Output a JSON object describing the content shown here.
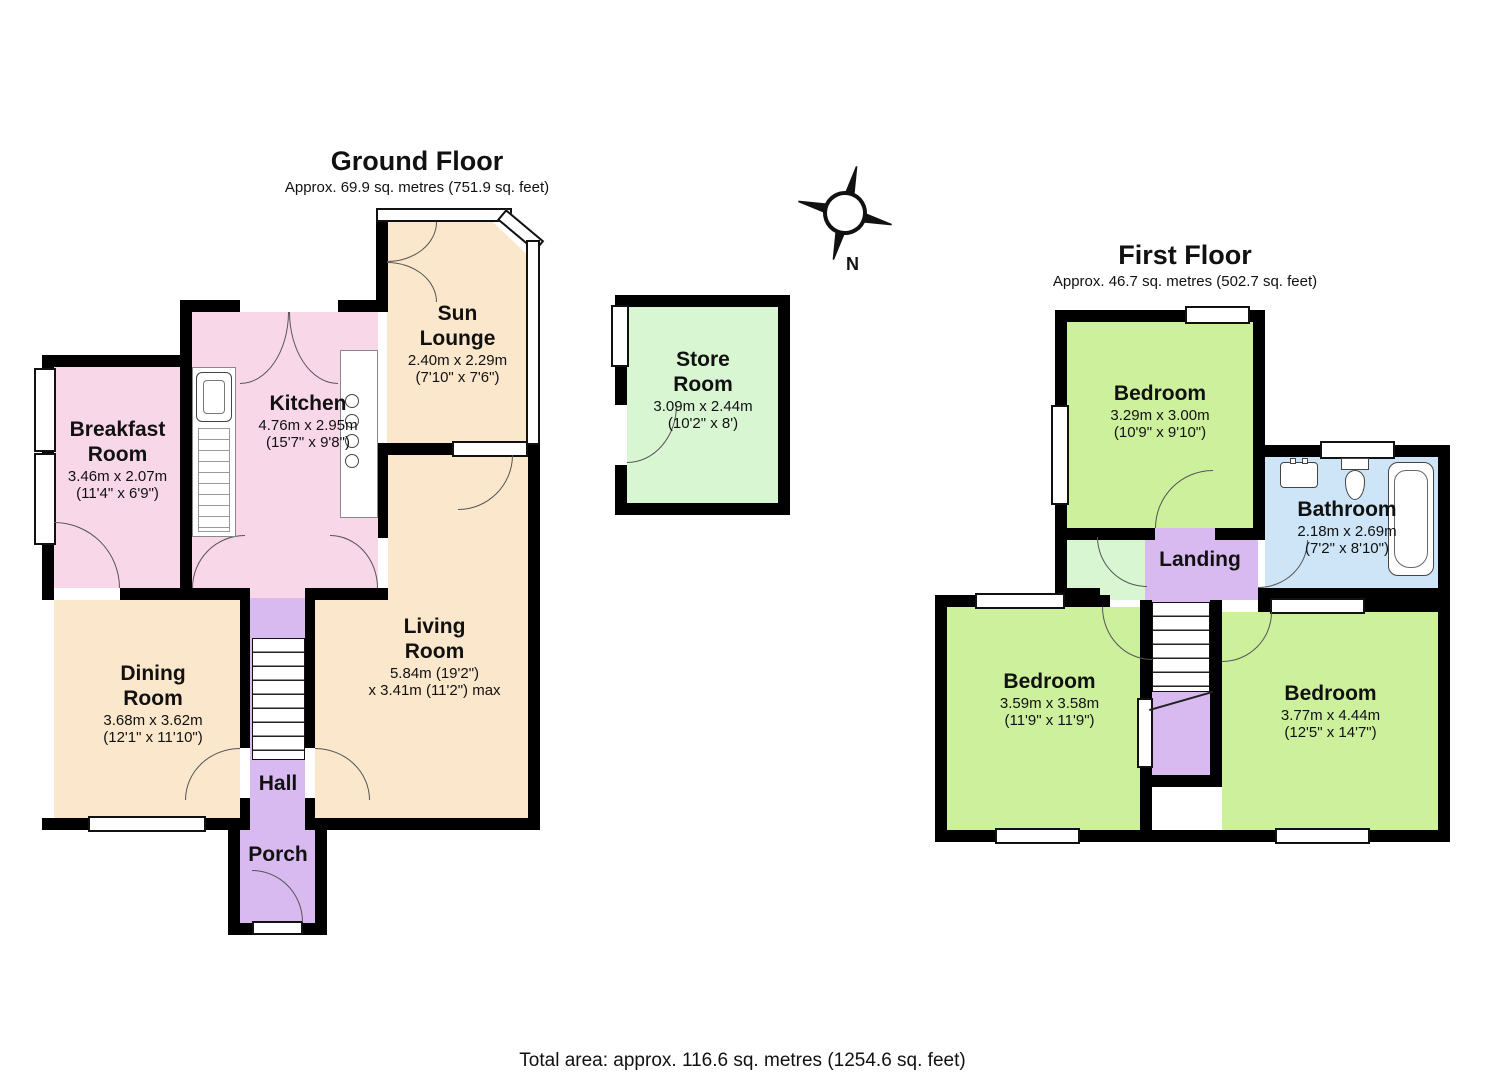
{
  "ground_floor": {
    "title": "Ground Floor",
    "subtitle": "Approx. 69.9 sq. metres (751.9 sq. feet)",
    "rooms": {
      "breakfast": {
        "name": "Breakfast Room",
        "dims1": "3.46m x 2.07m",
        "dims2": "(11'4\" x 6'9\")"
      },
      "kitchen": {
        "name": "Kitchen",
        "dims1": "4.76m x 2.95m",
        "dims2": "(15'7\" x 9'8\")"
      },
      "sun_lounge": {
        "name": "Sun Lounge",
        "dims1": "2.40m x 2.29m",
        "dims2": "(7'10\" x 7'6\")"
      },
      "dining": {
        "name": "Dining Room",
        "dims1": "3.68m x 3.62m",
        "dims2": "(12'1\" x 11'10\")"
      },
      "living": {
        "name": "Living Room",
        "dims1": "5.84m (19'2\")",
        "dims2": "x 3.41m (11'2\") max"
      },
      "hall": {
        "name": "Hall"
      },
      "porch": {
        "name": "Porch"
      }
    }
  },
  "store_room": {
    "name": "Store Room",
    "dims1": "3.09m x 2.44m",
    "dims2": "(10'2\" x 8')"
  },
  "first_floor": {
    "title": "First Floor",
    "subtitle": "Approx. 46.7 sq. metres (502.7 sq. feet)",
    "rooms": {
      "bedroom_top": {
        "name": "Bedroom",
        "dims1": "3.29m x 3.00m",
        "dims2": "(10'9\" x 9'10\")"
      },
      "bathroom": {
        "name": "Bathroom",
        "dims1": "2.18m x 2.69m",
        "dims2": "(7'2\" x 8'10\")"
      },
      "landing": {
        "name": "Landing"
      },
      "bedroom_left": {
        "name": "Bedroom",
        "dims1": "3.59m x 3.58m",
        "dims2": "(11'9\" x 11'9\")"
      },
      "bedroom_right": {
        "name": "Bedroom",
        "dims1": "3.77m x 4.44m",
        "dims2": "(12'5\" x 14'7\")"
      }
    }
  },
  "compass": {
    "label": "N"
  },
  "footer": {
    "total_area": "Total area: approx. 116.6 sq. metres (1254.6 sq. feet)"
  },
  "palette": {
    "room_pink": "#f8d7e9",
    "room_cream": "#fbe7cb",
    "room_lavender": "#d8baf1",
    "room_pale_green": "#d9f6d3",
    "room_green": "#cdf09c",
    "room_blue": "#cde5f7",
    "wall": "#000000"
  }
}
